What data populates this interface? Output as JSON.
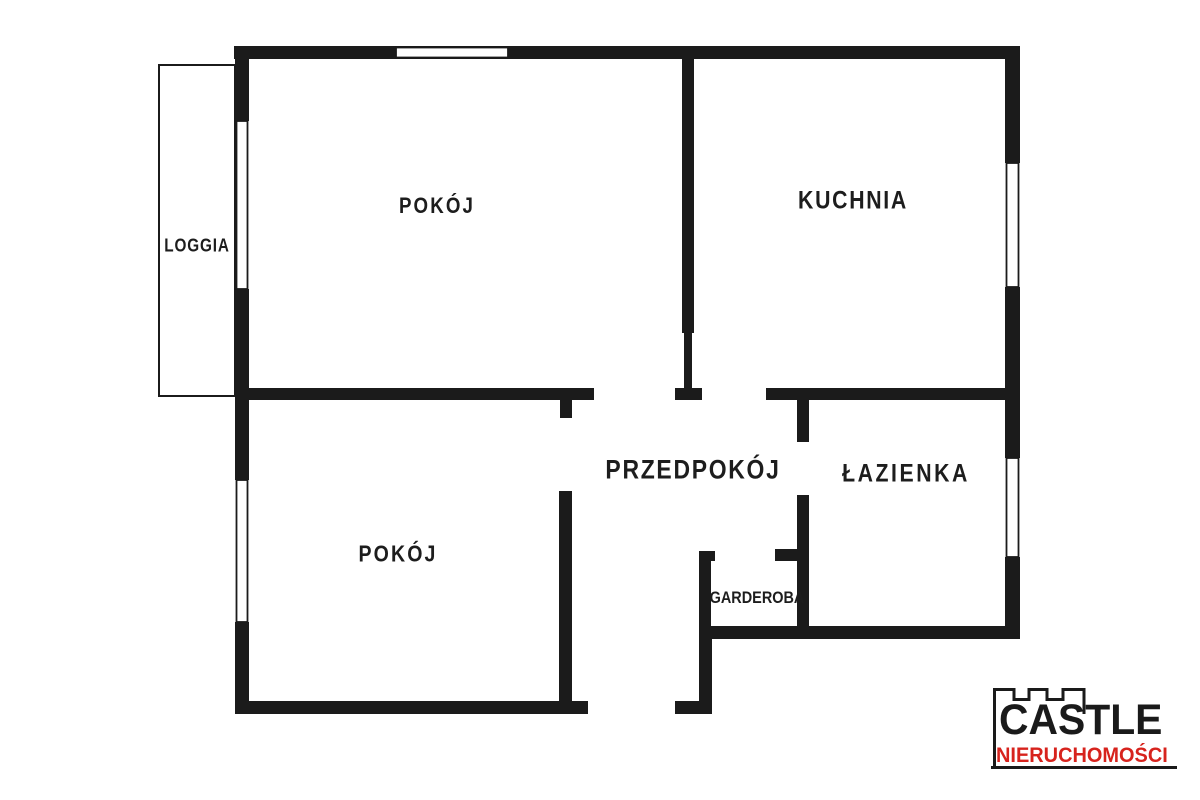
{
  "plan": {
    "type": "apartment-floor-plan",
    "rooms": {
      "pokoj_top": {
        "label": "POKÓJ"
      },
      "kuchnia": {
        "label": "KUCHNIA"
      },
      "loggia": {
        "label": "LOGGIA"
      },
      "przedpokoj": {
        "label": "PRZEDPOKÓJ"
      },
      "lazienka": {
        "label": "ŁAZIENKA"
      },
      "garderoba": {
        "label": "GARDEROBA"
      },
      "pokoj_bottom": {
        "label": "POKÓJ"
      }
    }
  },
  "logo": {
    "brand": "CASTLE",
    "tagline": "NIERUCHOMOŚCI"
  },
  "colors": {
    "background": "#ffffff",
    "wall": "#1b1b1b",
    "label": "#1d1d1d",
    "logo_black": "#1a1a1a",
    "logo_red": "#d7231d"
  }
}
